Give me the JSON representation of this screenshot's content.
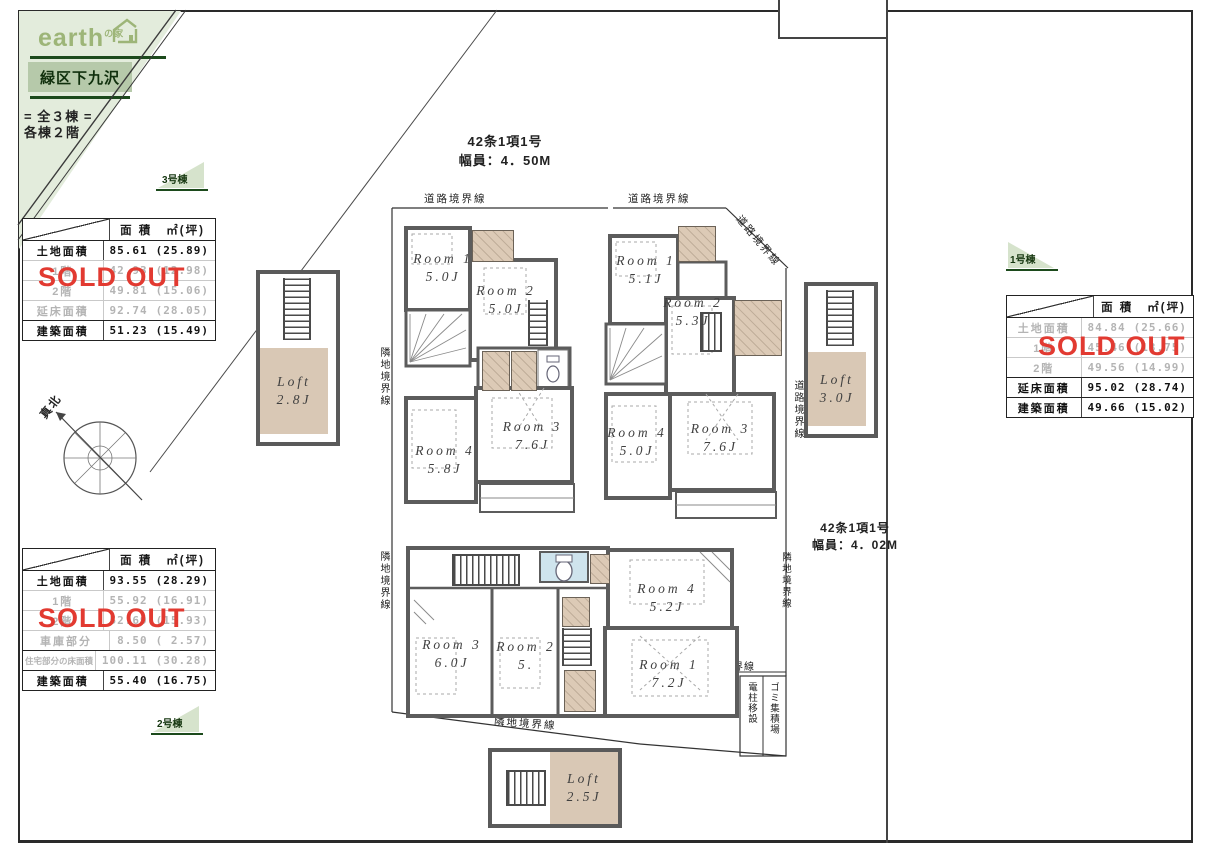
{
  "branding": {
    "logo": "earth",
    "logo_sub": "の家",
    "location": "緑区下九沢",
    "units_line": "=  全３棟  =",
    "floors_line": "各棟２階"
  },
  "sold_out_label": "SOLD OUT",
  "compass_label": "真北",
  "roads": {
    "top_law": "42条1項1号",
    "top_width": "幅員：4．50M",
    "right_law": "42条1項1号",
    "right_width": "幅員：4．02M"
  },
  "flags": {
    "no1": "1号棟",
    "no2": "2号棟",
    "no3": "3号棟"
  },
  "boundaries": {
    "road_top_left": "道路境界線",
    "road_top_mid": "道路境界線",
    "road_diag": "道路境界線",
    "road_right": "道路境界線",
    "neighbor_left_upper": "隣地境界線",
    "neighbor_left_lower": "隣地境界線",
    "neighbor_bottom": "隣地境界線",
    "neighbor_right": "隣地境界線",
    "neighbor_mid": "隣地境界線",
    "garbage": "ゴミ集積場",
    "pole": "電柱移設"
  },
  "tables": {
    "no3": {
      "col_area": "面 積",
      "col_unit": "㎡(坪)",
      "rows": [
        {
          "label": "土地面積",
          "sqm": "85.61",
          "tsubo": "(25.89)"
        },
        {
          "label": "1階",
          "sqm": "42.93",
          "tsubo": "(12.98)"
        },
        {
          "label": "2階",
          "sqm": "49.81",
          "tsubo": "(15.06)"
        },
        {
          "label": "延床面積",
          "sqm": "92.74",
          "tsubo": "(28.05)"
        },
        {
          "label": "建築面積",
          "sqm": "51.23",
          "tsubo": "(15.49)"
        }
      ]
    },
    "no2": {
      "col_area": "面 積",
      "col_unit": "㎡(坪)",
      "rows": [
        {
          "label": "土地面積",
          "sqm": "93.55",
          "tsubo": "(28.29)"
        },
        {
          "label": "1階",
          "sqm": "55.92",
          "tsubo": "(16.91)"
        },
        {
          "label": "2階",
          "sqm": "52.69",
          "tsubo": "(15.93)"
        },
        {
          "label": "車庫部分",
          "sqm": "8.50",
          "tsubo": "( 2.57)"
        },
        {
          "label": "住宅部分の床面積",
          "sqm": "100.11",
          "tsubo": "(30.28)"
        },
        {
          "label": "建築面積",
          "sqm": "55.40",
          "tsubo": "(16.75)"
        }
      ]
    },
    "no1": {
      "col_area": "面 積",
      "col_unit": "㎡(坪)",
      "rows": [
        {
          "label": "土地面積",
          "sqm": "84.84",
          "tsubo": "(25.66)"
        },
        {
          "label": "1階",
          "sqm": "45.46",
          "tsubo": "(13.75)"
        },
        {
          "label": "2階",
          "sqm": "49.56",
          "tsubo": "(14.99)"
        },
        {
          "label": "延床面積",
          "sqm": "95.02",
          "tsubo": "(28.74)"
        },
        {
          "label": "建築面積",
          "sqm": "49.66",
          "tsubo": "(15.02)"
        }
      ]
    }
  },
  "plans": {
    "no3": {
      "room1": {
        "name": "Room 1",
        "size": "5.0J"
      },
      "room2": {
        "name": "Room 2",
        "size": "5.0J"
      },
      "room3": {
        "name": "Room 3",
        "size": "7.6J"
      },
      "room4": {
        "name": "Room 4",
        "size": "5.8J"
      },
      "loft": {
        "name": "Loft",
        "size": "2.8J"
      }
    },
    "no1": {
      "room1": {
        "name": "Room 1",
        "size": "5.1J"
      },
      "room2": {
        "name": "Room 2",
        "size": "5.3J"
      },
      "room3": {
        "name": "Room 3",
        "size": "7.6J"
      },
      "room4": {
        "name": "Room 4",
        "size": "5.0J"
      },
      "loft": {
        "name": "Loft",
        "size": "3.0J"
      }
    },
    "no2": {
      "room1": {
        "name": "Room 1",
        "size": "7.2J"
      },
      "room2": {
        "name": "Room 2",
        "size": "5."
      },
      "room3": {
        "name": "Room 3",
        "size": "6.0J"
      },
      "room4": {
        "name": "Room 4",
        "size": "5.2J"
      },
      "loft": {
        "name": "Loft",
        "size": "2.5J"
      }
    }
  }
}
